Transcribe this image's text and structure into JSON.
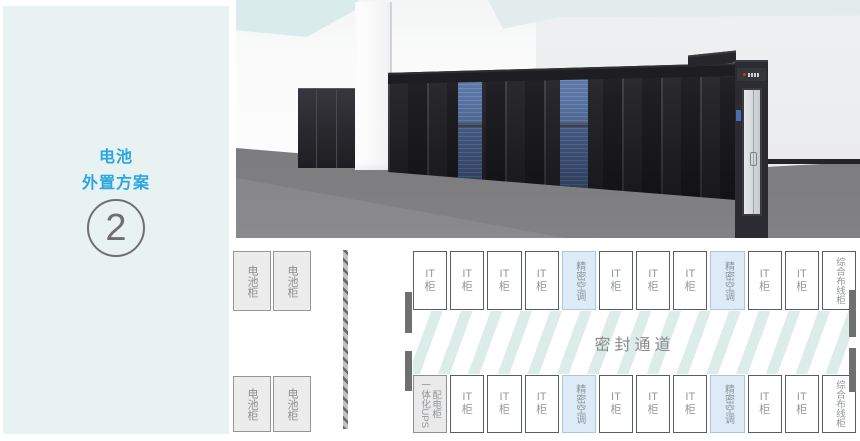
{
  "sidebar": {
    "title_lines": [
      "电池",
      "外置方案"
    ],
    "badge_number": "2"
  },
  "colors": {
    "sidebar_bg": "#e9f2f2",
    "title_blue": "#29a7e1",
    "ac_cabinet_fill": "#dcebf7",
    "aisle_stripe": "#dcede9",
    "rack_dark": "#26262b",
    "ac_door_blue": "#54709f",
    "floor_gray": "#7c7c7f",
    "ceiling_teal": "#d9ebea"
  },
  "plan": {
    "aisle_label": "密封通道",
    "battery_top": [
      {
        "label": "电池柜"
      },
      {
        "label": "电池柜"
      }
    ],
    "battery_bottom": [
      {
        "label": "电池柜"
      },
      {
        "label": "电池柜"
      }
    ],
    "top_row": [
      {
        "label": "IT柜",
        "type": "it"
      },
      {
        "label": "IT柜",
        "type": "it"
      },
      {
        "label": "IT柜",
        "type": "it"
      },
      {
        "label": "IT柜",
        "type": "it"
      },
      {
        "label": "精密空调",
        "type": "ac"
      },
      {
        "label": "IT柜",
        "type": "it"
      },
      {
        "label": "IT柜",
        "type": "it"
      },
      {
        "label": "IT柜",
        "type": "it"
      },
      {
        "label": "精密空调",
        "type": "ac"
      },
      {
        "label": "IT柜",
        "type": "it"
      },
      {
        "label": "IT柜",
        "type": "it"
      },
      {
        "label": "综合布线柜",
        "type": "cabling"
      }
    ],
    "bottom_row": [
      {
        "label": "一体化UPS配电柜",
        "type": "ups"
      },
      {
        "label": "IT柜",
        "type": "it"
      },
      {
        "label": "IT柜",
        "type": "it"
      },
      {
        "label": "IT柜",
        "type": "it"
      },
      {
        "label": "精密空调",
        "type": "ac"
      },
      {
        "label": "IT柜",
        "type": "it"
      },
      {
        "label": "IT柜",
        "type": "it"
      },
      {
        "label": "IT柜",
        "type": "it"
      },
      {
        "label": "精密空调",
        "type": "ac"
      },
      {
        "label": "IT柜",
        "type": "it"
      },
      {
        "label": "IT柜",
        "type": "it"
      },
      {
        "label": "综合布线柜",
        "type": "cabling"
      }
    ]
  }
}
